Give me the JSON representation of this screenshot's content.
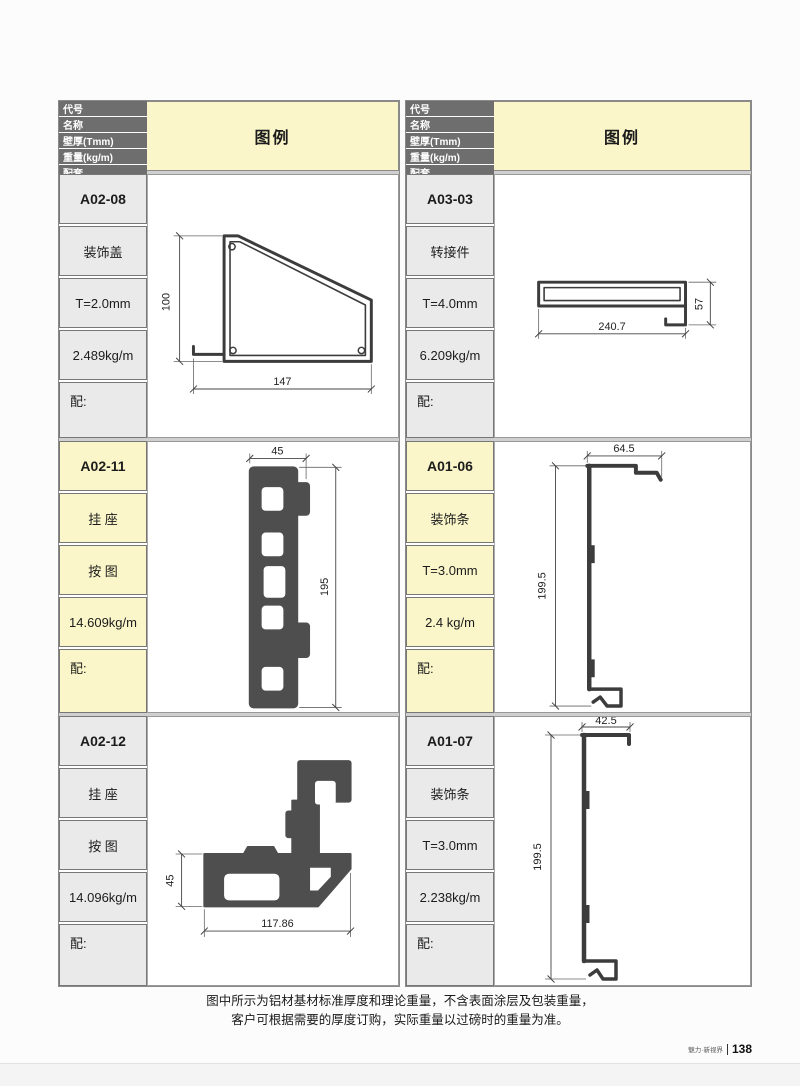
{
  "header": {
    "labels": [
      "代号",
      "名称",
      "壁厚(Tmm)",
      "重量(kg/m)",
      "配套"
    ],
    "legend": "图例"
  },
  "colors": {
    "header_bg": "#6E6E6E",
    "legend_cream": "#FAF6C9",
    "cell_gray": "#EAEAEA",
    "profile_fill": "#4E4E4E",
    "drawing_line": "#3C3C3C"
  },
  "tables": [
    {
      "rows": [
        {
          "code": "A02-08",
          "name": "装饰盖",
          "thickness": "T=2.0mm",
          "weight": "2.489kg/m",
          "match": "配:",
          "dim_w": "147",
          "dim_h": "100"
        },
        {
          "code": "A02-11",
          "name": "挂 座",
          "thickness": "按 图",
          "weight": "14.609kg/m",
          "match": "配:",
          "dim_w": "45",
          "dim_h": "195"
        },
        {
          "code": "A02-12",
          "name": "挂 座",
          "thickness": "按 图",
          "weight": "14.096kg/m",
          "match": "配:",
          "dim_w": "117.86",
          "dim_h": "45"
        }
      ]
    },
    {
      "rows": [
        {
          "code": "A03-03",
          "name": "转接件",
          "thickness": "T=4.0mm",
          "weight": "6.209kg/m",
          "match": "配:",
          "dim_w": "240.7",
          "dim_h": "57"
        },
        {
          "code": "A01-06",
          "name": "装饰条",
          "thickness": "T=3.0mm",
          "weight": "2.4 kg/m",
          "match": "配:",
          "dim_w": "64.5",
          "dim_h": "199.5"
        },
        {
          "code": "A01-07",
          "name": "装饰条",
          "thickness": "T=3.0mm",
          "weight": "2.238kg/m",
          "match": "配:",
          "dim_w": "42.5",
          "dim_h": "199.5"
        }
      ]
    }
  ],
  "footer": {
    "note_line1": "图中所示为铝材基材标准厚度和理论重量，不含表面涂层及包装重量，",
    "note_line2": "客户可根据需要的厚度订购，实际重量以过磅时的重量为准。",
    "brand": "魅力·新视界",
    "page_number": "138"
  }
}
